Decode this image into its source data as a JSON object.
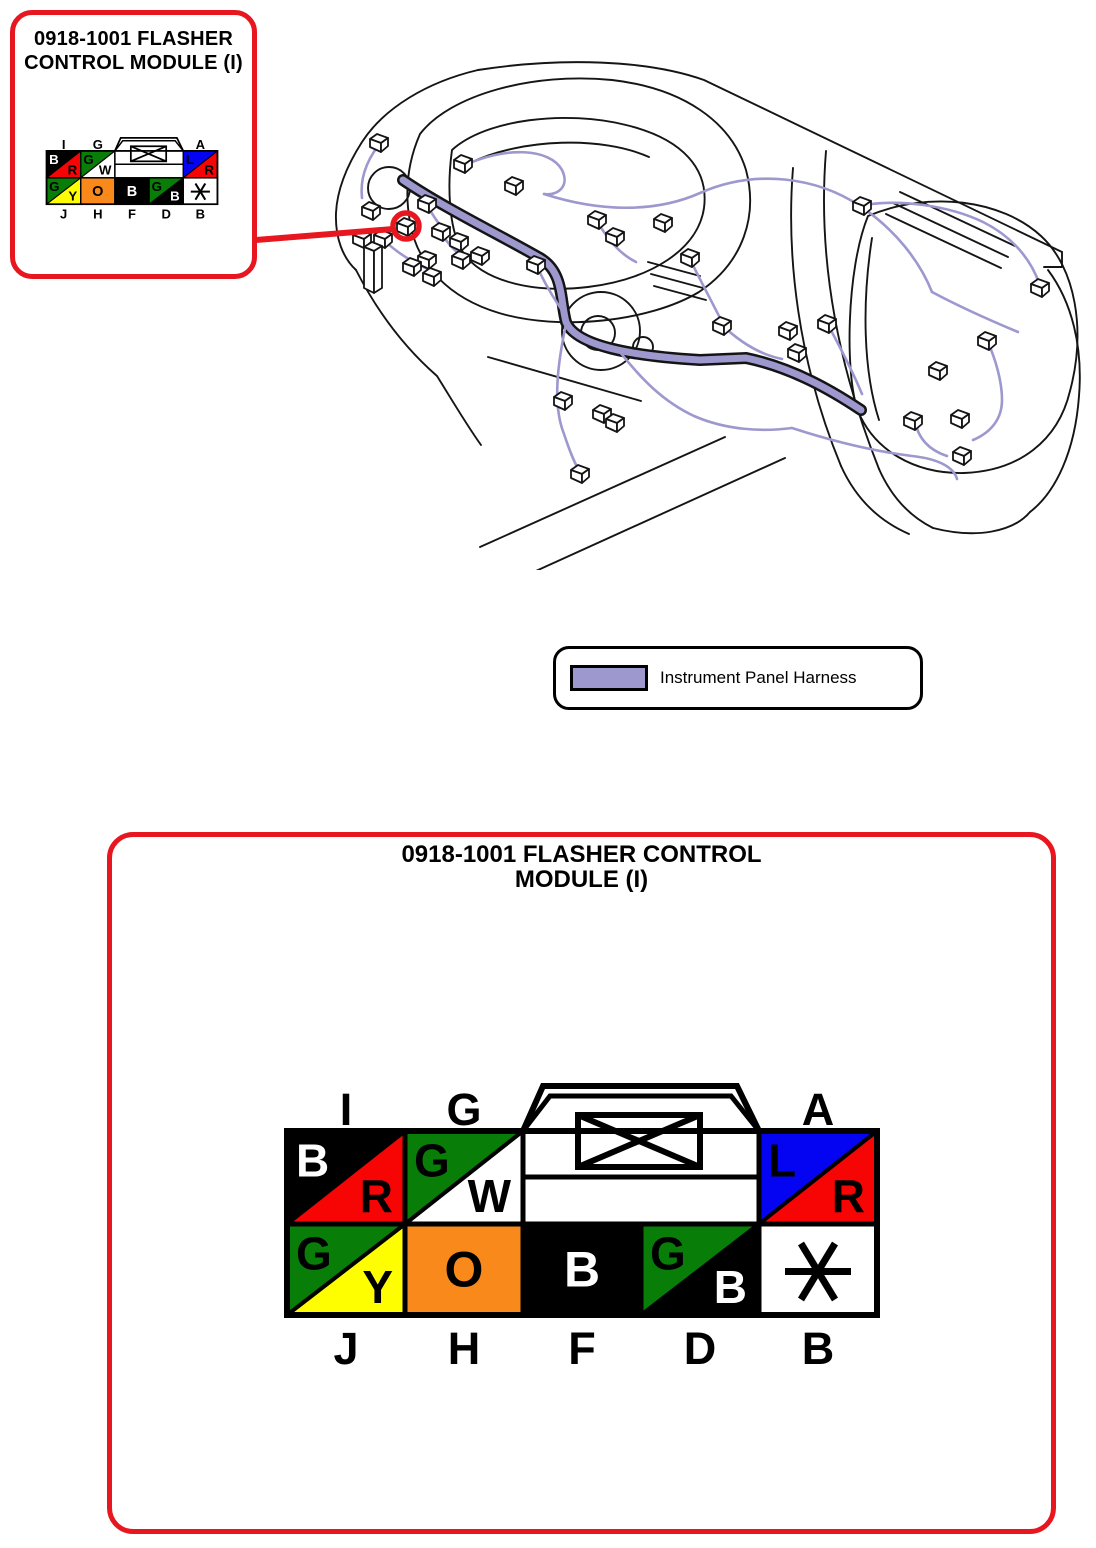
{
  "colors": {
    "outline_red": "#e8171f",
    "pin_red": "#f70505",
    "green": "#087d08",
    "blue": "#0404f2",
    "yellow": "#fffe00",
    "orange": "#f9891b",
    "black": "#000000",
    "white": "#ffffff",
    "harness": "#9d98ce",
    "line_black": "#151515"
  },
  "callout_box": {
    "title_line1": "0918-1001 FLASHER",
    "title_line2": "CONTROL MODULE (I)"
  },
  "detail_box": {
    "title_line1": "0918-1001 FLASHER CONTROL",
    "title_line2": "MODULE (I)"
  },
  "legend": {
    "label": "Instrument Panel Harness"
  },
  "connector": {
    "top_pins": [
      {
        "label": "I",
        "bg": "black",
        "tri": "pin_red",
        "tl": {
          "t": "B",
          "c": "white"
        },
        "br": {
          "t": "R",
          "c": "black"
        }
      },
      {
        "label": "G",
        "bg": "green",
        "tri": "white",
        "tl": {
          "t": "G",
          "c": "black"
        },
        "br": {
          "t": "W",
          "c": "black"
        }
      },
      {
        "label": "A",
        "bg": "blue",
        "tri": "pin_red",
        "tl": {
          "t": "L",
          "c": "black"
        },
        "br": {
          "t": "R",
          "c": "black"
        }
      }
    ],
    "bottom_pins": [
      {
        "label": "J",
        "bg": "green",
        "tri": "yellow",
        "tl": {
          "t": "G",
          "c": "black"
        },
        "br": {
          "t": "Y",
          "c": "black"
        }
      },
      {
        "label": "H",
        "bg": "orange",
        "center": {
          "t": "O",
          "c": "black"
        }
      },
      {
        "label": "F",
        "bg": "black",
        "center": {
          "t": "B",
          "c": "white"
        }
      },
      {
        "label": "D",
        "bg": "green",
        "tri": "black",
        "tl": {
          "t": "G",
          "c": "black"
        },
        "br": {
          "t": "B",
          "c": "white"
        }
      },
      {
        "label": "B",
        "bg": "white",
        "asterisk": "black"
      }
    ]
  }
}
